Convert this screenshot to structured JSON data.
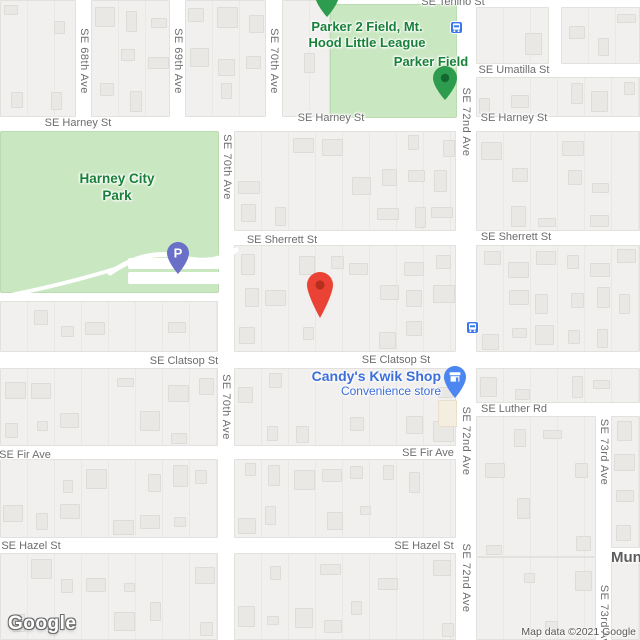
{
  "map": {
    "logo": "Google",
    "attribution": "Map data ©2021 Google"
  },
  "colors": {
    "park_green_fill": "#C9E7C1",
    "park_label_green": "#188038",
    "poi_blue": "#3C6EDC",
    "street_label_gray": "#6D6D6D",
    "destination_pin_red": "#EA4335",
    "parking_pin_purple": "#6A70C7",
    "place_pin_green": "#2E9C4E",
    "shop_pin_blue": "#4C86F0",
    "transit_blue": "#3A78E8",
    "road_white": "#FFFFFF",
    "block_gray": "#F1F0EE"
  },
  "pois": {
    "parker2_field": {
      "label": "Parker 2 Field, Mt. Hood Little League"
    },
    "parker_field": {
      "label": "Parker Field"
    },
    "harney_city_park": {
      "label": "Harney City Park"
    },
    "candys_kwik_shop": {
      "name": "Candy's Kwik Shop",
      "category": "Convenience store"
    },
    "truncated_place": {
      "label": "Mund"
    }
  },
  "markers": {
    "destination_pin": {
      "type": "red-marker",
      "near": "SE Sherrett St / SE Clatsop St block"
    },
    "parking_pin": {
      "glyph": "P",
      "location": "Harney City Park"
    },
    "parker_field_pin": {
      "type": "green-place-pin"
    },
    "north_green_pin": {
      "type": "green-place-pin (cut off at top edge)"
    },
    "candys_pin": {
      "type": "blue-shop-pin"
    },
    "transit_stops_count": 2
  },
  "street_labels": [
    {
      "text": "SE Tenino St",
      "x": 453,
      "y": 2,
      "v": 0
    },
    {
      "text": "SE Umatilla St",
      "x": 514,
      "y": 70,
      "v": 0
    },
    {
      "text": "SE Harney St",
      "x": 78,
      "y": 123,
      "v": 0
    },
    {
      "text": "SE Harney St",
      "x": 331,
      "y": 118,
      "v": 0
    },
    {
      "text": "SE Harney St",
      "x": 514,
      "y": 118,
      "v": 0
    },
    {
      "text": "SE Sherrett St",
      "x": 282,
      "y": 240,
      "v": 0
    },
    {
      "text": "SE Sherrett St",
      "x": 516,
      "y": 237,
      "v": 0
    },
    {
      "text": "SE Clatsop St",
      "x": 184,
      "y": 361,
      "v": 0
    },
    {
      "text": "SE Clatsop St",
      "x": 396,
      "y": 360,
      "v": 0
    },
    {
      "text": "SE Luther Rd",
      "x": 514,
      "y": 409,
      "v": 0
    },
    {
      "text": "SE Fir Ave",
      "x": 25,
      "y": 455,
      "v": 0
    },
    {
      "text": "SE Fir Ave",
      "x": 428,
      "y": 453,
      "v": 0
    },
    {
      "text": "SE Hazel St",
      "x": 31,
      "y": 546,
      "v": 0
    },
    {
      "text": "SE Hazel St",
      "x": 424,
      "y": 546,
      "v": 0
    },
    {
      "text": "SE 68th Ave",
      "x": 84,
      "y": 61,
      "v": 1
    },
    {
      "text": "SE 69th Ave",
      "x": 178,
      "y": 61,
      "v": 1
    },
    {
      "text": "SE 70th Ave",
      "x": 274,
      "y": 61,
      "v": 1
    },
    {
      "text": "SE 70th Ave",
      "x": 227,
      "y": 167,
      "v": 1
    },
    {
      "text": "SE 70th Ave",
      "x": 226,
      "y": 407,
      "v": 1
    },
    {
      "text": "SE 72nd Ave",
      "x": 466,
      "y": 122,
      "v": 1
    },
    {
      "text": "SE 72nd Ave",
      "x": 466,
      "y": 441,
      "v": 1
    },
    {
      "text": "SE 72nd Ave",
      "x": 466,
      "y": 578,
      "v": 1
    },
    {
      "text": "SE 73rd Ave",
      "x": 604,
      "y": 452,
      "v": 1
    },
    {
      "text": "SE 73rd Ave",
      "x": 604,
      "y": 618,
      "v": 1
    }
  ]
}
